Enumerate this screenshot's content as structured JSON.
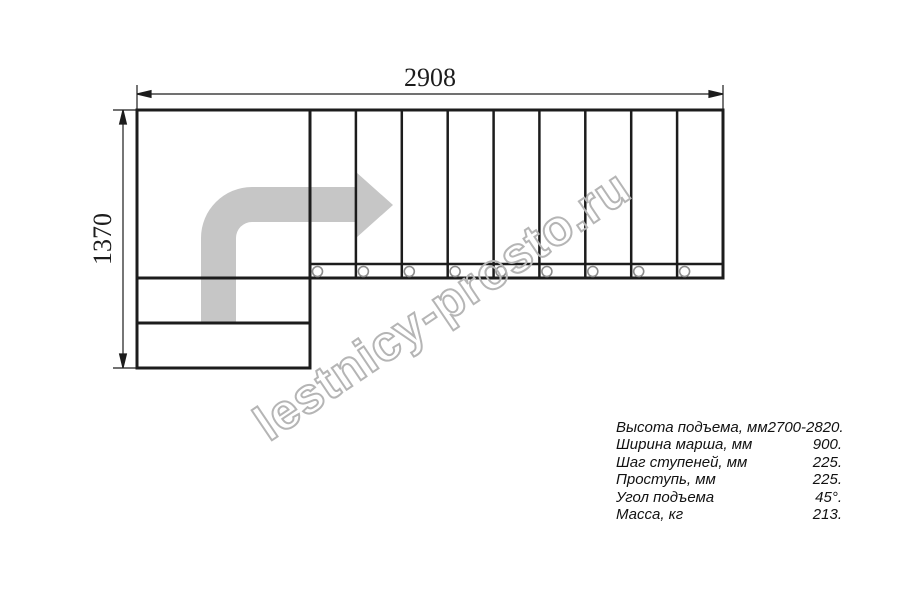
{
  "drawing": {
    "watermark": "lestnicy-prosto.ru",
    "dimensions": {
      "top_width_mm": "2908",
      "left_height_mm": "1370"
    },
    "steps": {
      "top_flight_step_count": 9,
      "bottom_flight_step_count": 2,
      "baluster_circle_count": 9
    },
    "colors": {
      "line": "#1c1c1c",
      "arrow_fill": "#c6c6c6",
      "watermark_stroke": "#b5b5b5",
      "baluster_stroke": "#8c8c8c"
    }
  },
  "spec": {
    "rows": [
      {
        "label": "Высота подъема, мм",
        "value": "2700-2820."
      },
      {
        "label": "Ширина марша, мм",
        "value": "900."
      },
      {
        "label": "Шаг ступеней, мм",
        "value": "225."
      },
      {
        "label": "Проступь, мм",
        "value": "225."
      },
      {
        "label": "Угол подъема",
        "value": "45°."
      },
      {
        "label": "Масса, кг",
        "value": "213."
      }
    ]
  }
}
